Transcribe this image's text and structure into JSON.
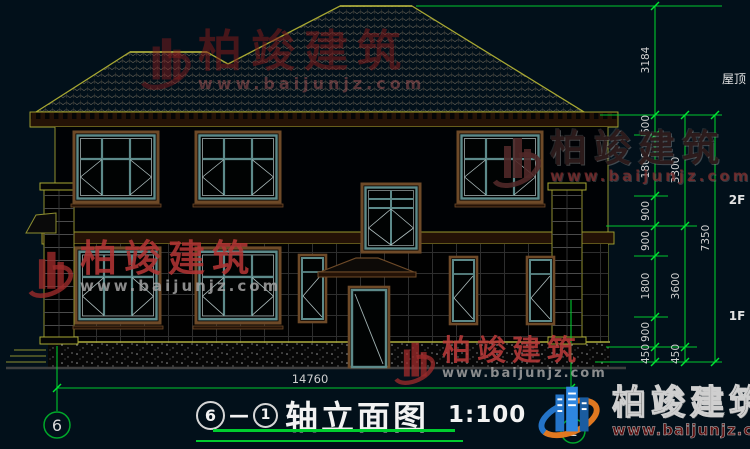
{
  "drawing": {
    "title": {
      "prefix_axis": "6",
      "dash": "—",
      "suffix_axis": "1",
      "name": "轴立面图",
      "scale": "1:100"
    },
    "axis_bubbles": {
      "left": "6",
      "right": "1"
    },
    "dims": {
      "total_width": "14760",
      "v1": [
        "3184",
        "600",
        "1800",
        "900",
        "900",
        "1800",
        "900",
        "450"
      ],
      "v2": [
        "3300",
        "3600",
        "450"
      ],
      "v3": [
        "7350"
      ],
      "levels": {
        "roof": "屋顶",
        "f2": "2F",
        "f1": "1F"
      }
    }
  },
  "watermark": {
    "brand": "柏竣建筑",
    "url": "www.baijunjz.com"
  },
  "logo": {
    "brand": "柏竣建筑",
    "url": "www.baijunjz.com"
  },
  "colors": {
    "background": "#02101a",
    "dim_green": "#00c82e",
    "line_yellow": "#a8a832",
    "frame_teal": "#5d8a8a",
    "frame_brown": "#6e4a28",
    "watermark_red": "#a03232"
  }
}
